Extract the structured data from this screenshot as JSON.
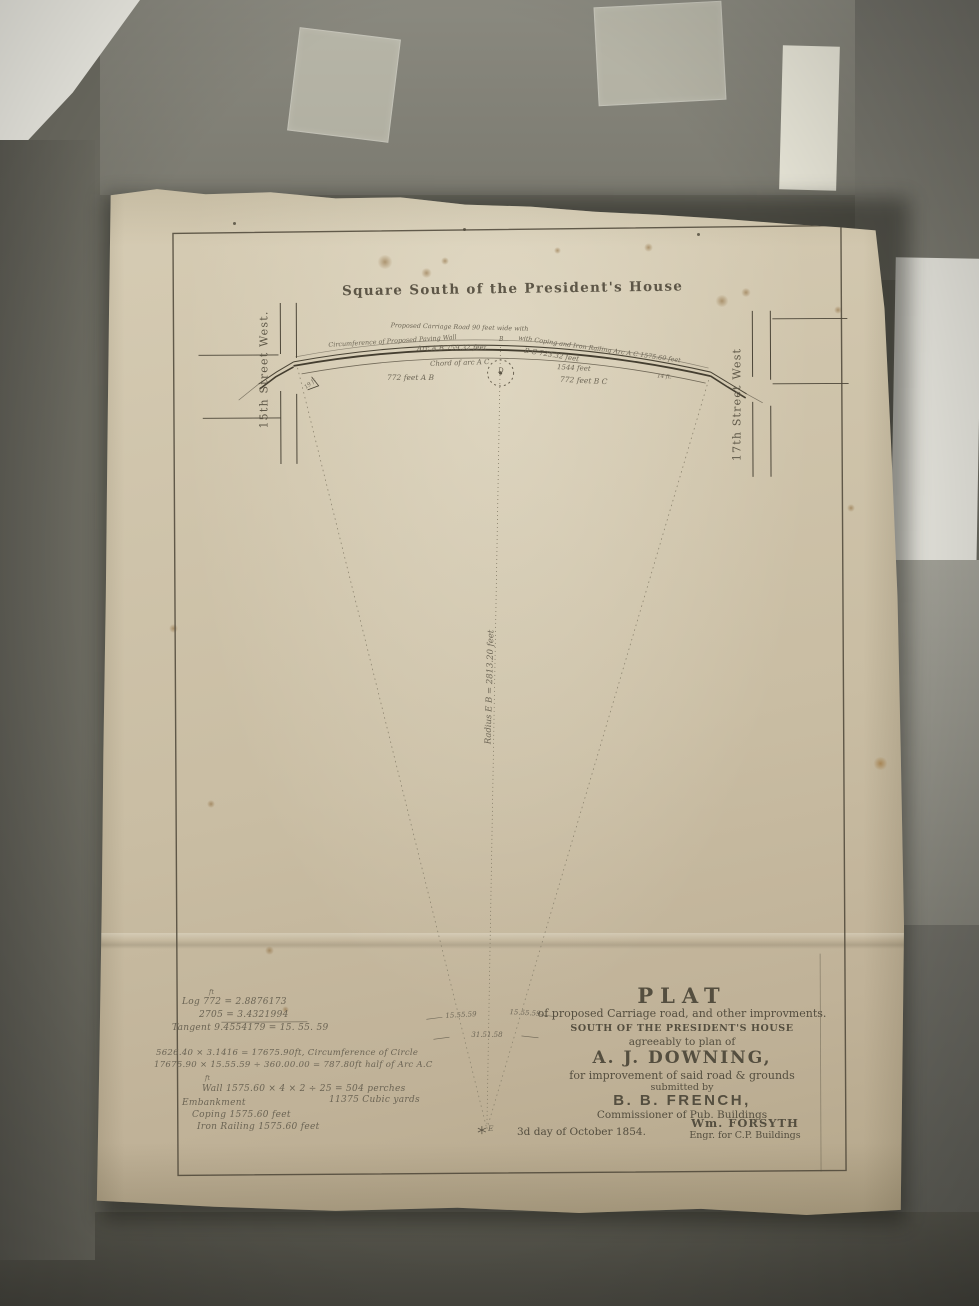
{
  "photo": {
    "background_color": "#6e6d63",
    "paper_color": "#cbc0a6",
    "ink_color": "#564f3f"
  },
  "plat": {
    "map_title": "Square South of the President's House",
    "street_left": "15th Street West.",
    "street_right": "17th Street West",
    "radius_label": "Radius E B = 2813.20 feet",
    "curve": {
      "road": "Proposed Carriage Road 90 feet wide with",
      "wall": "Circumference of Proposed Paving Wall",
      "railing": "with Coping and Iron Railing Arc A C 1575.60 feet",
      "arc_ab": "Arc A B 759.32 feet",
      "arc_bc": "B C 723.32 feet",
      "chord": "Chord of arc A C",
      "chord_len": "1544 feet",
      "half_ab": "772 feet A B",
      "half_bc": "772 feet B C",
      "small_left": "19 ft",
      "small_right": "14 ft.",
      "point_b": "B",
      "point_d": "D",
      "point_e": "E"
    },
    "angles": {
      "left": "15.55.59",
      "right": "15.55.59",
      "total": "31.51.58"
    },
    "calc": {
      "sup_ft": "ft",
      "log1": "Log  772 = 2.8876173",
      "log2": "2705 = 3.4321994",
      "log3": "Tangent  9.4554179 = 15. 55. 59",
      "circ1": "5626.40 × 3.1416 = 17675.90ft, Circumference of Circle",
      "circ2": "17675.90 × 15.55.59 ÷ 360.00.00 = 787.80ft half of Arc A.C",
      "wall": "Wall 1575.60 × 4 × 2 ÷ 25 = 504 perches",
      "embankment": "Embankment",
      "embankment_val": "11375 Cubic yards",
      "coping": "Coping 1575.60 feet",
      "iron_railing": "Iron Railing 1575.60 feet"
    },
    "title_block": {
      "heading": "PLAT",
      "line1": "of proposed Carriage road, and other improvments.",
      "line2": "SOUTH OF THE PRESIDENT'S HOUSE",
      "line3": "agreeably to plan of",
      "name1": "A. J. DOWNING,",
      "line4": "for improvement of said road & grounds",
      "line5": "submitted by",
      "name2": "B. B. FRENCH,",
      "line6": "Commissioner of Pub. Buildings",
      "date": "3d day of October 1854.",
      "name3": "Wm. FORSYTH",
      "line7": "Engr. for C.P. Buildings"
    }
  }
}
